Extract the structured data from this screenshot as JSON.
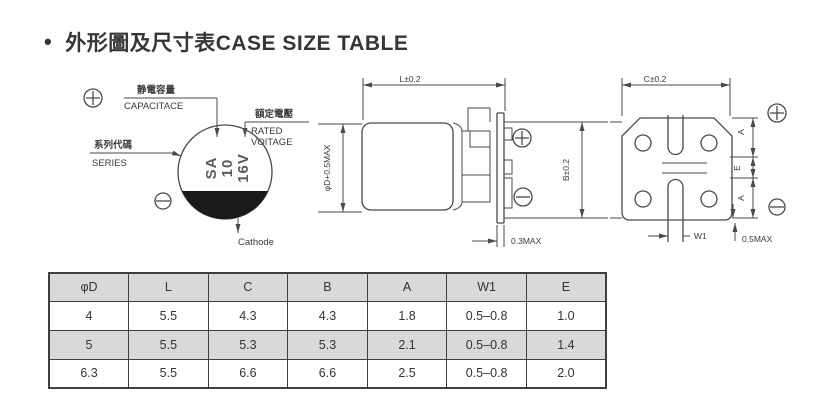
{
  "title": {
    "bullet": "•",
    "text": "外形圖及尺寸表CASE SIZE TABLE"
  },
  "colors": {
    "line": "#4a4a4a",
    "text": "#3b3b3b",
    "table_fill": "#d9d9d9",
    "cathode_stripe": "#1a1a1a",
    "background": "#fefefe"
  },
  "diagrams": {
    "marking_view": {
      "capacitance_cn": "静電容量",
      "capacitance_en": "CAPACITACE",
      "rated_voltage_cn": "額定電壓",
      "rated_voltage_en_line1": "RATED",
      "rated_voltage_en_line2": "VOITAGE",
      "series_cn": "系列代碼",
      "series_en": "SERIES",
      "marking_line1": "SA",
      "marking_line2": "10",
      "marking_line3": "16V",
      "cathode_label": "Cathode"
    },
    "side_view": {
      "dim_length": "L±0.2",
      "dim_diameter": "φD+0.5MAX",
      "dim_height": "B±0.2",
      "dim_plate_thickness": "0.3MAX"
    },
    "bottom_view": {
      "dim_width": "C±0.2",
      "dim_a_top": "A",
      "dim_e": "E",
      "dim_a_bottom": "A",
      "dim_w1": "W1",
      "dim_lead": "0.5MAX"
    }
  },
  "table": {
    "headers": [
      "φD",
      "L",
      "C",
      "B",
      "A",
      "W1",
      "E"
    ],
    "rows": [
      [
        "4",
        "5.5",
        "4.3",
        "4.3",
        "1.8",
        "0.5–0.8",
        "1.0"
      ],
      [
        "5",
        "5.5",
        "5.3",
        "5.3",
        "2.1",
        "0.5–0.8",
        "1.4"
      ],
      [
        "6.3",
        "5.5",
        "6.6",
        "6.6",
        "2.5",
        "0.5–0.8",
        "2.0"
      ]
    ]
  }
}
